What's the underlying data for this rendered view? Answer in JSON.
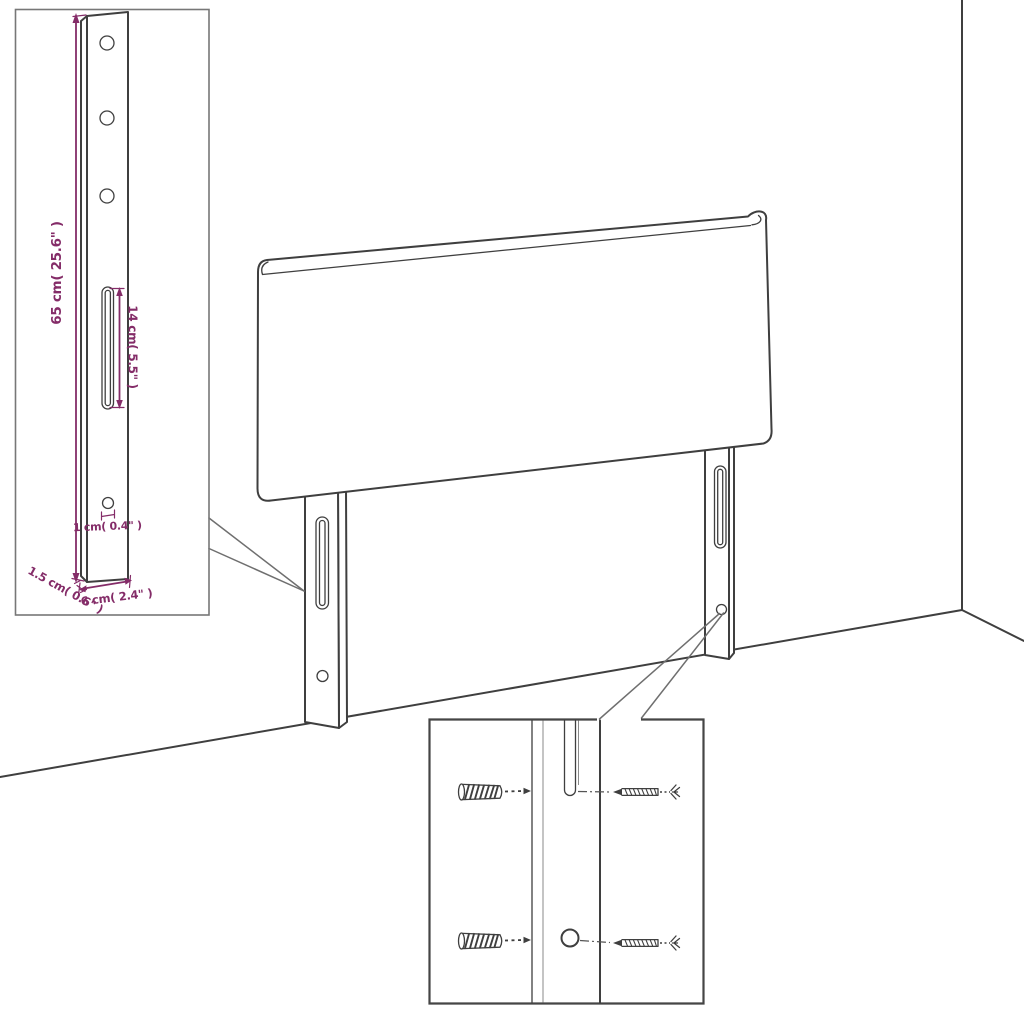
{
  "colors": {
    "background": "#ffffff",
    "line": "#3f3f3f",
    "line_soft": "#6f6f6f",
    "dimension": "#842c68"
  },
  "dimensions": {
    "height_label": "65 cm( 25.6\" )",
    "slot_label": "14 cm( 5.5\" )",
    "hole_label": "1 cm( 0.4\" )",
    "depth_label": "1.5 cm( 0.6\" )",
    "width_label": "6 cm( 2.4\" )"
  }
}
